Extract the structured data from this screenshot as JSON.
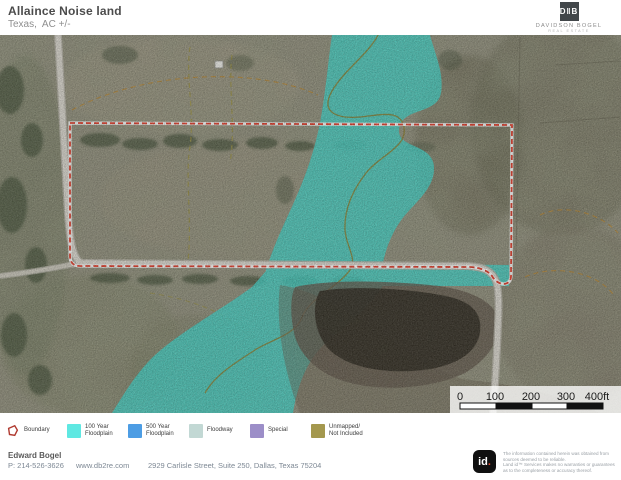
{
  "header": {
    "title": "Allaince Noise land",
    "subtitle": "Texas,  AC +/-",
    "brand": {
      "mark": "D‖B",
      "name": "DAVIDSON BOGEL",
      "tagline": "REAL ESTATE"
    }
  },
  "map": {
    "overlay_colors": {
      "floodplain_100yr": "#3ed8cd",
      "boundary_red": "#e23b28"
    },
    "scale_bar": {
      "ticks": [
        "0",
        "100",
        "200",
        "300",
        "400ft"
      ]
    }
  },
  "legend": {
    "items": [
      {
        "label": "Boundary",
        "type": "boundary-outline",
        "color": "#b03a30"
      },
      {
        "label": "100 Year Floodplain",
        "type": "swatch",
        "color": "#5fe8e2"
      },
      {
        "label": "500 Year Floodplain",
        "type": "swatch",
        "color": "#4d9de4"
      },
      {
        "label": "Floodway",
        "type": "swatch",
        "color": "#c2d8d4"
      },
      {
        "label": "Special",
        "type": "swatch",
        "color": "#9c8ec8"
      },
      {
        "label": "Unmapped/ Not Included",
        "type": "swatch",
        "color": "#a4984e"
      }
    ]
  },
  "footer": {
    "agent_name": "Edward Bogel",
    "phone": "P: 214-526-3626",
    "website": "www.db2re.com",
    "address": "2929 Carlisle Street, Suite 250, Dallas, Texas 75204"
  },
  "attribution": {
    "logo_text": "id",
    "logo_dot": ".",
    "disclaimer_lines": [
      "The information contained herein was obtained from",
      "sources deemed to be reliable.",
      "Land id™ Services makes no warranties or guarantees",
      "as to the completeness or accuracy thereof."
    ]
  }
}
